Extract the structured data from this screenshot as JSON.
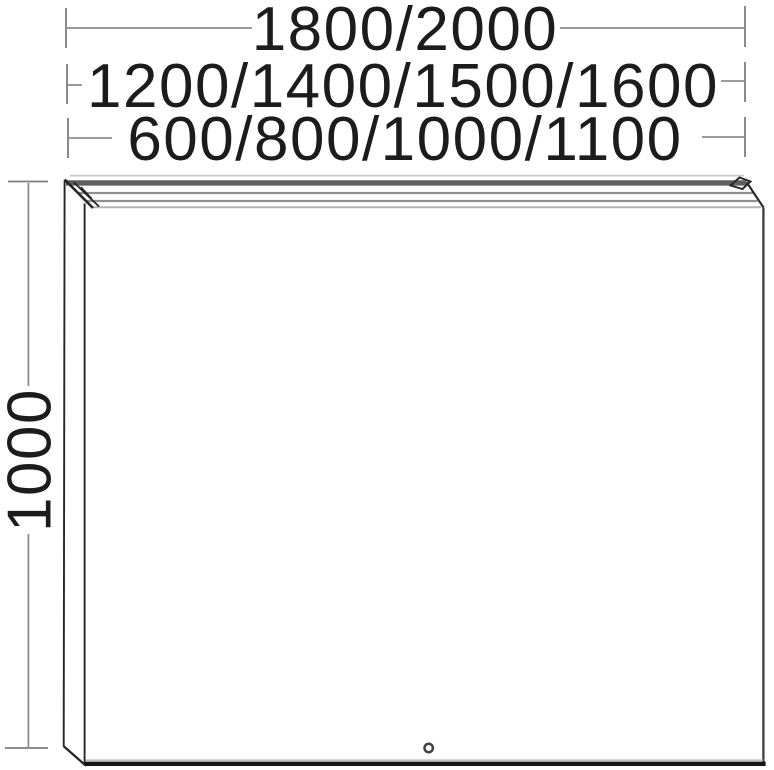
{
  "colors": {
    "background": "#ffffff",
    "ink": "#1c1c1c",
    "dim-line": "#8d8d8d",
    "dim-tick": "#7e7e7e",
    "outline": "#262626",
    "outline-heavy": "#141414",
    "canopy-band": "#5f5f5f",
    "canopy-line": "#8f8f8f",
    "canopy-light": "#c9c9c9",
    "edge-soft": "#bdbdbd"
  },
  "dimensions": {
    "width_top": {
      "label": "1800/2000"
    },
    "width_middle": {
      "label": "1200/1400/1500/1600"
    },
    "width_bottom": {
      "label": "600/800/1000/1100"
    },
    "height_left": {
      "label": "1000"
    }
  }
}
